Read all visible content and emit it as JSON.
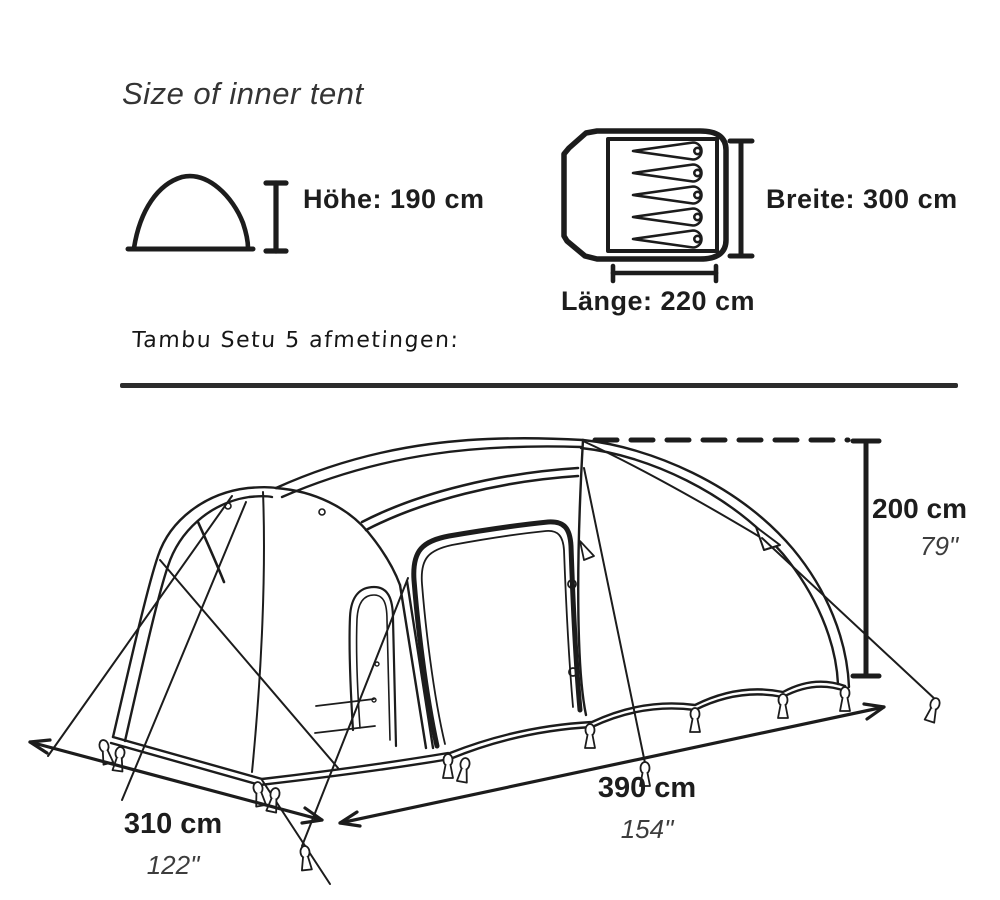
{
  "header": {
    "title": "Size of inner tent"
  },
  "note": {
    "text": "Tambu Setu 5 afmetingen:"
  },
  "inner_tent": {
    "height_label": "Höhe: 190 cm",
    "width_label": "Breite: 300 cm",
    "length_label": "Länge: 220 cm"
  },
  "outer_tent": {
    "depth_cm": "310 cm",
    "depth_in": "122\"",
    "length_cm": "390 cm",
    "length_in": "154\"",
    "height_cm": "200 cm",
    "height_in": "79\""
  },
  "icons": {
    "side_profile": "tent-side-profile-icon",
    "floorplan": "tent-floorplan-icon",
    "sleeping_pads_count": 5
  },
  "colors": {
    "ink": "#1c1c1c",
    "muted": "#3d3d3d",
    "background": "#ffffff"
  }
}
